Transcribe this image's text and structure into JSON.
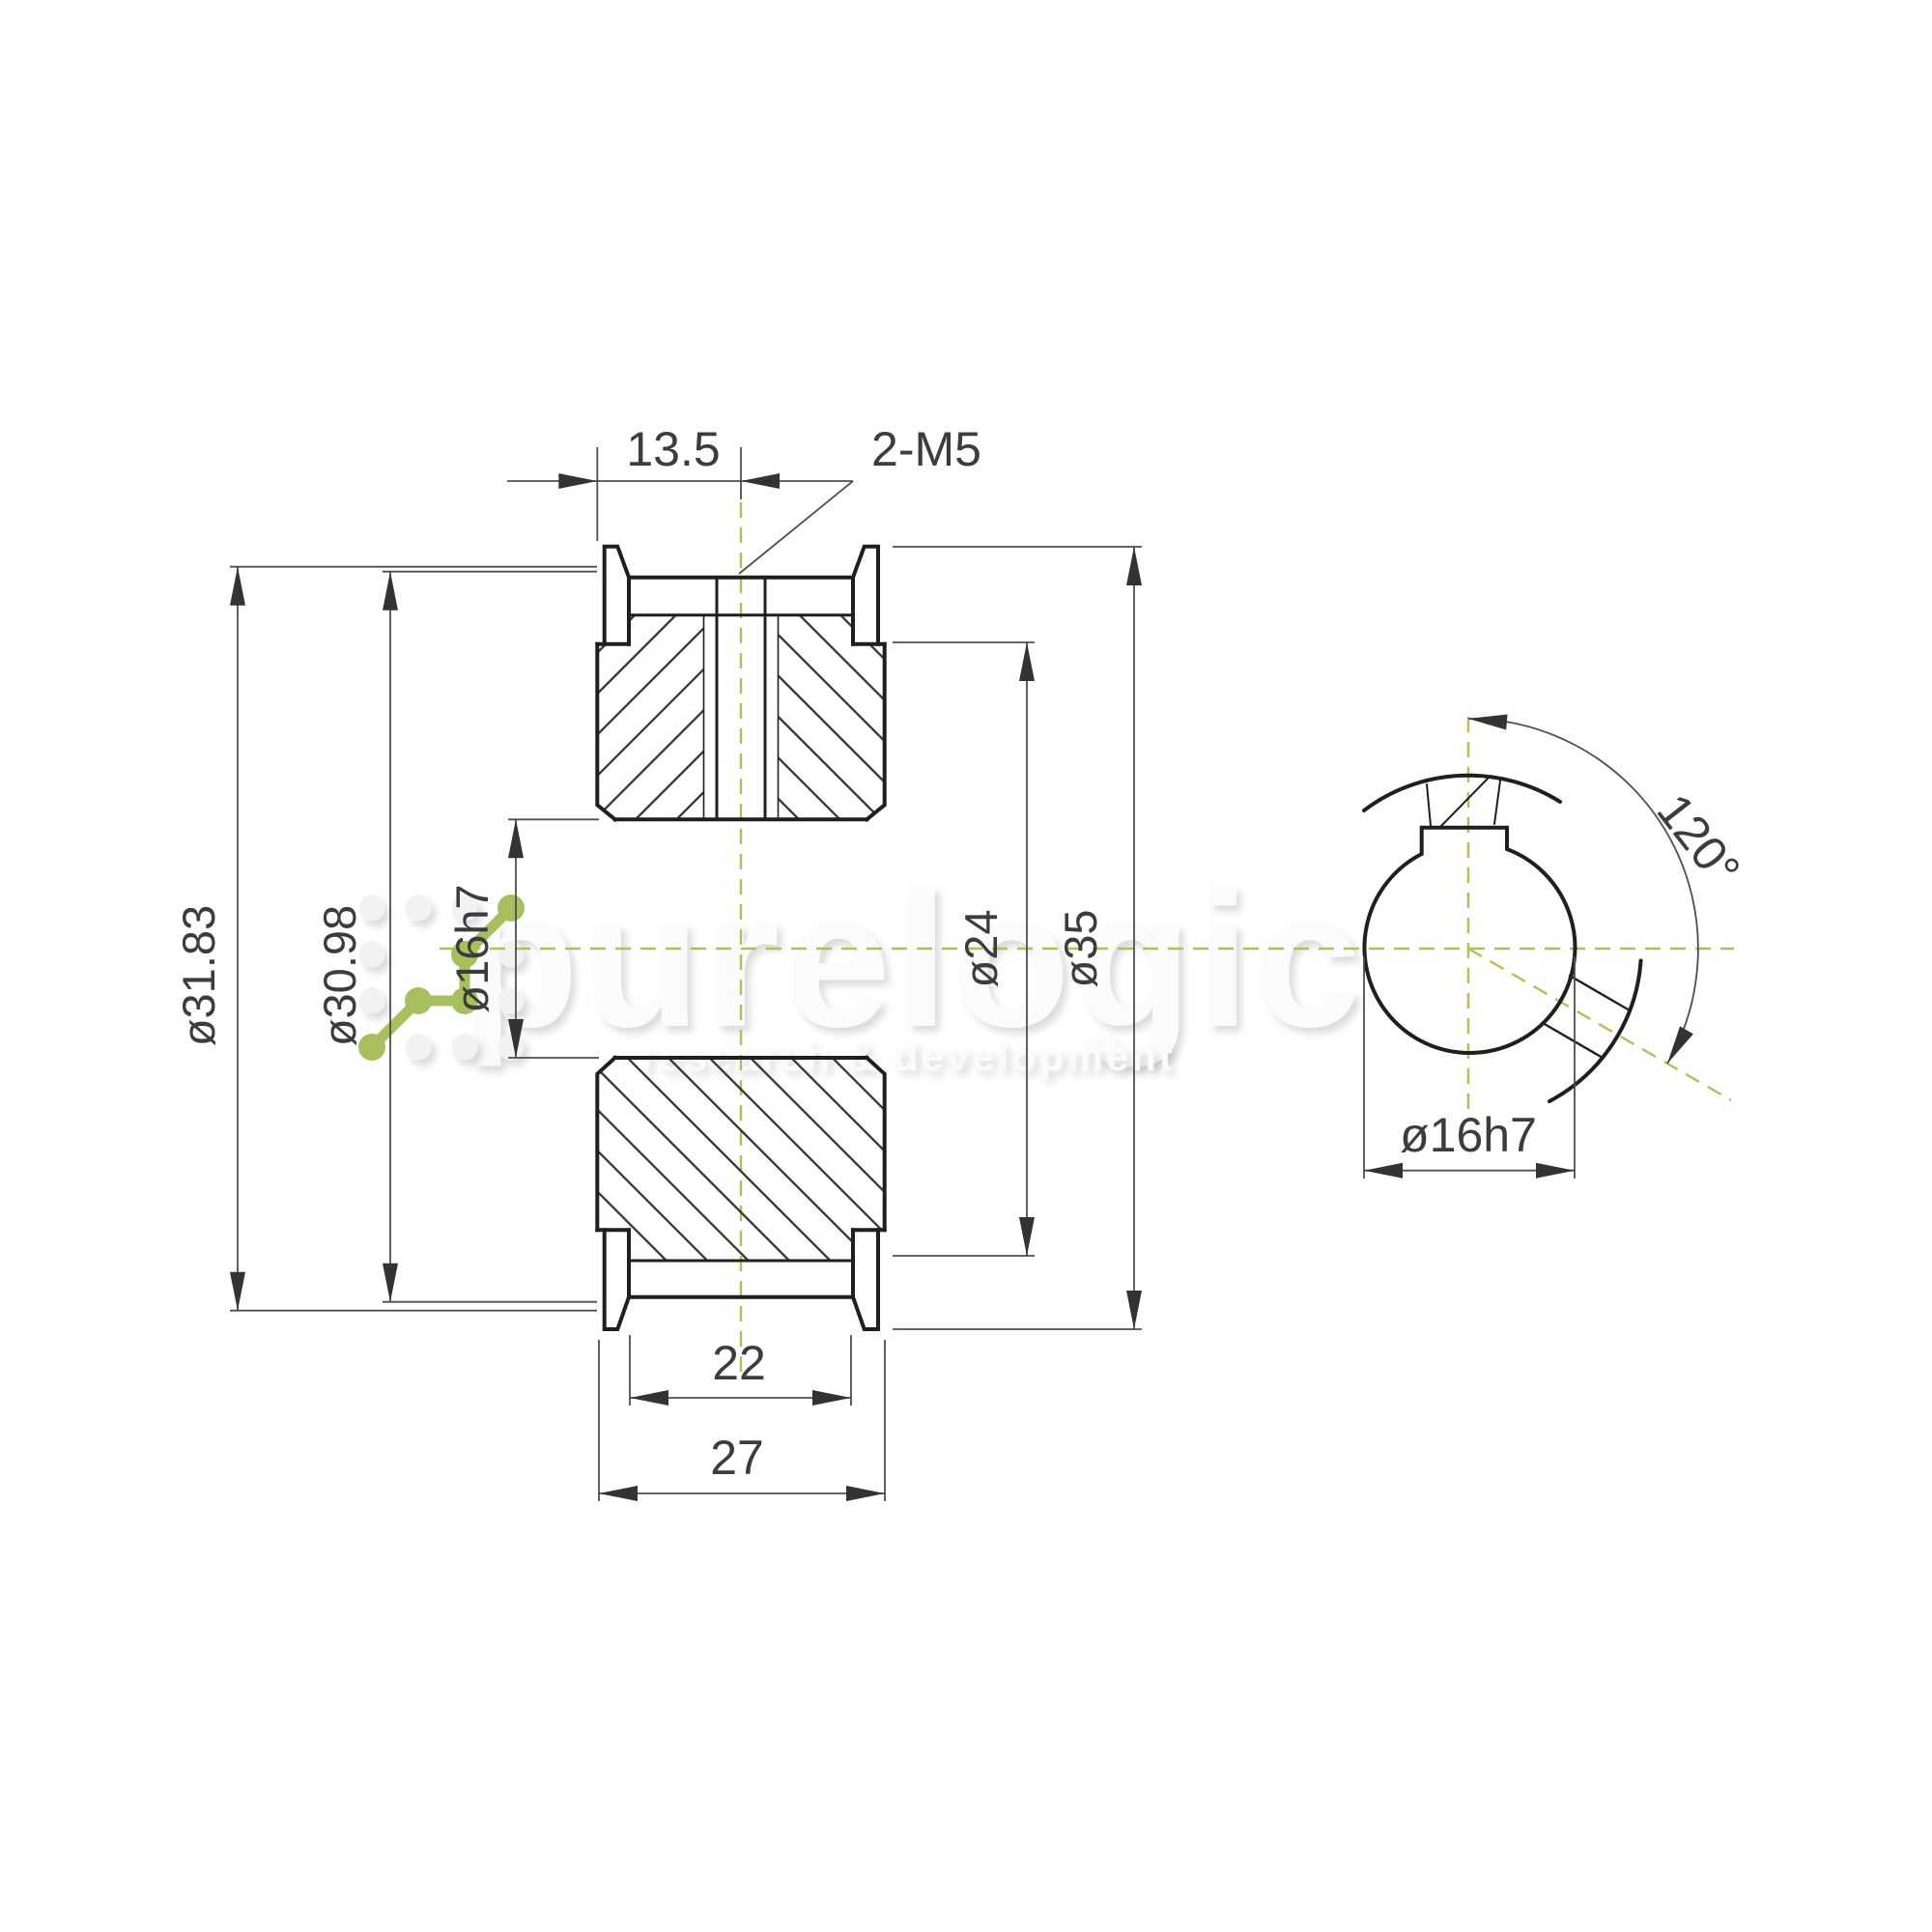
{
  "drawing": {
    "title": "Timing pulley cross-section drawing",
    "labels": {
      "pitch_dia": "ø31.83",
      "outside_dia": "ø30.98",
      "bore_dia_front": "ø16h7",
      "hub_dia": "ø24",
      "flange_dia": "ø35",
      "hole_offset": "13.5",
      "setscrew": "2-M5",
      "belt_width": "22",
      "overall_width": "27",
      "bore_dia_side": "ø16h7",
      "setscrew_angle": "120°"
    },
    "watermark": {
      "brand": "purelogic",
      "tagline": "research & development"
    },
    "colors": {
      "centerline_green": "#a4c653",
      "logo_green": "#a7bf5c",
      "outline_dark": "#1f1f1f",
      "dim_gray": "#4f4f4f",
      "text_gray": "#3c3c3c",
      "watermark_gray": "#fbfbfb"
    }
  }
}
